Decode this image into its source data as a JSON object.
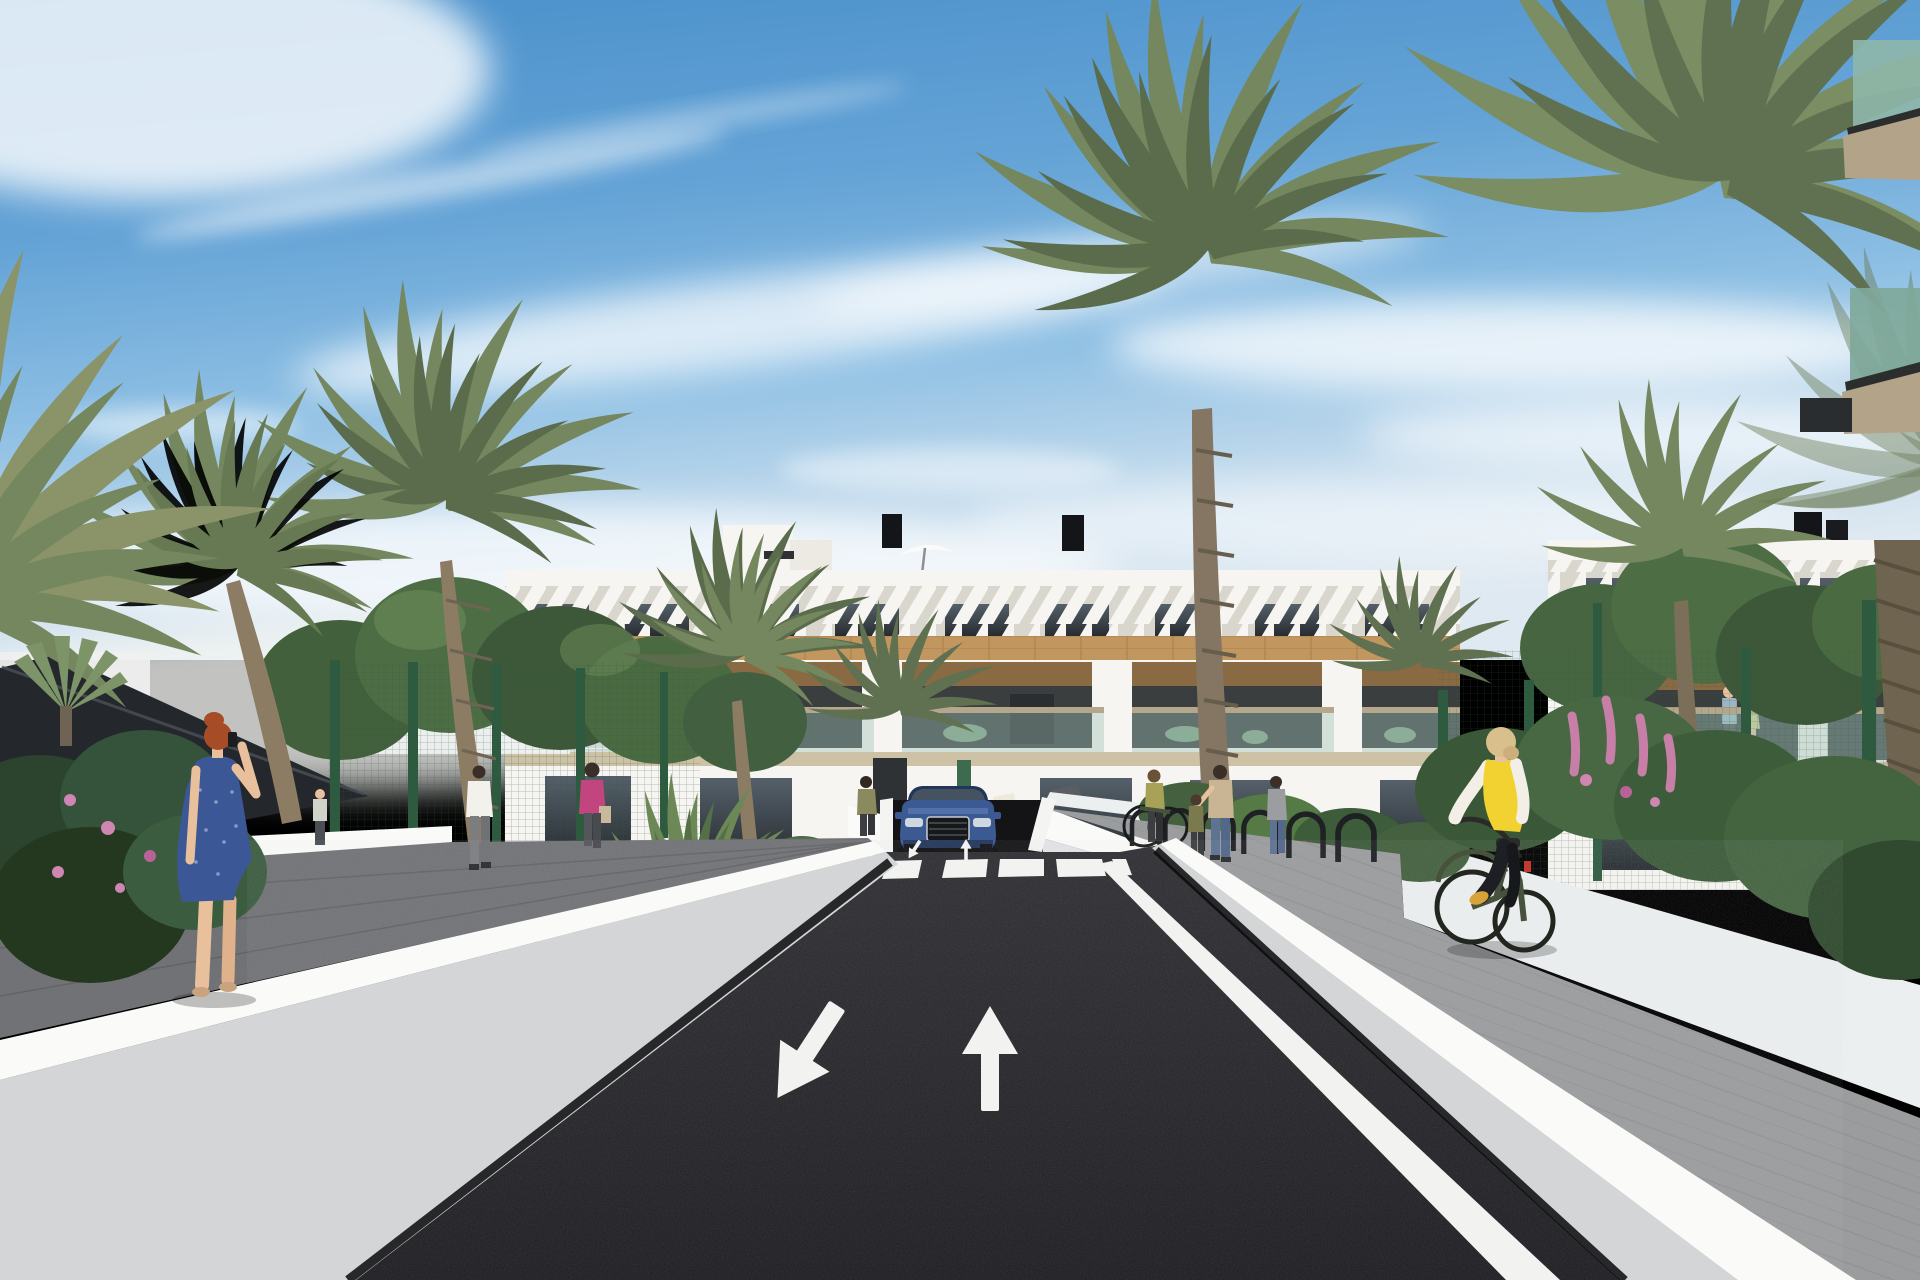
{
  "scene": {
    "type": "architectural-render",
    "setting": "street-level view of a modern white Mediterranean apartment complex with palm trees, entrance road, crosswalk and underground garage ramp",
    "objects": [
      "sky",
      "cirrus-clouds",
      "apartment-building",
      "penthouse",
      "rooftop-umbrellas",
      "chimneys",
      "louver-fins-facade",
      "wood-cladding",
      "pergola-balconies",
      "glass-balustrades",
      "palm-trees",
      "leafy-trees",
      "shade-canopy",
      "green-mesh-fence",
      "flower-beds",
      "white-planter-walls",
      "asphalt-road",
      "zebra-crosswalk",
      "lane-arrows",
      "road-edge-line",
      "underground-garage-ramp",
      "blue-suv",
      "bike-racks",
      "pedestrians",
      "woman-on-phone",
      "cyclist-yellow-vest",
      "sidewalks",
      "green-glass-balconies"
    ]
  },
  "road_markings": {
    "left_lane_arrow": "down-left",
    "right_lane_arrow": "up",
    "crosswalk_stripes": 5,
    "mini_ramp_arrows": 2
  },
  "counts": {
    "rooftop_umbrellas": 2,
    "chimneys": 5,
    "visible_pedestrians": 10,
    "cyclists": 1,
    "cars": 1
  },
  "colors": {
    "sky_top": "#4a90cb",
    "cloud": "#ffffff",
    "asphalt": "#26262a",
    "marking": "#f2f2f0",
    "wall_bright": "#fafaf9",
    "wall_face": "#d4d5d7",
    "sidewalk_left": "#717276",
    "sidewalk_right": "#9b9c9e",
    "canopy": "#24282c",
    "fence": "#2e5a40",
    "building_white": "#f6f5f1",
    "fins_bg": "#d9d6cd",
    "wood": "#c2965f",
    "pergola": "#8a6a42",
    "glass": "#34383a",
    "slab": "#cdc1a6",
    "rail": "#b4a78c",
    "palm": "#75875e",
    "palm_dark": "#5a6c4b",
    "tree": "#4c6847",
    "trunk": "#8c7c64",
    "car_blue": "#3b5a94",
    "car_dark": "#22365a",
    "vest_yellow": "#f1d231",
    "dress_blue": "#3c5795",
    "hair_red": "#a64d28",
    "skin": "#e9c09c",
    "pink_top": "#c24580",
    "bike_green": "#46523c",
    "flower_pink": "#cf86b2",
    "flower_orange": "#d5842f",
    "grass": "#5d7f49",
    "balcony_glass_green": "#8fb7aa",
    "soffit_tan": "#b3a489",
    "jeans": "#5d7391",
    "olive_top": "#8a8a5e",
    "shirt_white": "#f2f1ec"
  }
}
